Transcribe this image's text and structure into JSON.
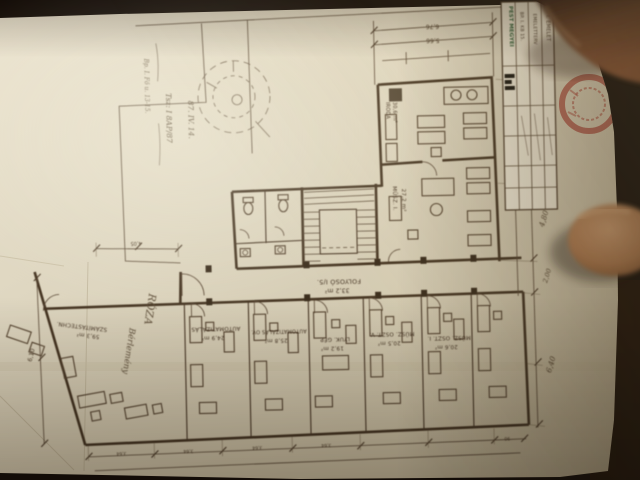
{
  "colors": {
    "table_surface": "#1a110a",
    "paper": "#ddd5bf",
    "ink": "#4a3826",
    "pencil": "#5f4f3a",
    "stamp_red": "#a63327",
    "skin": "#b5835f",
    "title_green": "#2f5c34"
  },
  "title_block": {
    "org": "PEST MEGYEI",
    "logo": "FTV",
    "row1": "BP. I. KB 15.",
    "row2": "EMELETTERV",
    "row3": "I. EMELET"
  },
  "handwritten_notes": {
    "line1": "Bp. I. Fő u. 13-15.",
    "line2": "Tsz: I 8AP/87",
    "line3": "87. IV. 14."
  },
  "site_notes": {
    "plot_name": "RÓZA",
    "plot_note": "Bérlemény"
  },
  "corridor": {
    "name": "FOLYOSÓ I/5.",
    "area": "33,2 m²"
  },
  "rooms": {
    "corner": {
      "name": "SZÁMÍTÁSTECHN.",
      "area": "59,3 m²"
    },
    "r1": {
      "name": "AUTOMATIZÁLÁS",
      "area": "24,9 m²"
    },
    "r2": {
      "name": "AUTOMATIZÁLÁS OV.",
      "area": "25,8 m²"
    },
    "r3": {
      "name": "LYUK. GÉP",
      "area": "19,2 m²"
    },
    "r4": {
      "name": "MŰSZ. OSZT. V.",
      "area": "20,5 m²"
    },
    "r5": {
      "name": "MŰSZ. OSZT. I.",
      "area": "20,6 m²"
    },
    "wing": {
      "name": "MŰSZ. I.",
      "area": "27,2 m²"
    },
    "wing_upper": {
      "name": "IRODA",
      "area": "30,6 m²"
    }
  },
  "dimensions": {
    "top1": "6,76",
    "top2": "5,66",
    "right1": "4,70",
    "right2": "4,80",
    "right3": "2,00",
    "right4": "6,40",
    "left1": "6,10",
    "inner1": "4,05",
    "bottom1": "3,64",
    "bottom2": "3,64",
    "bottom3": "3,64",
    "bottom4": "3,64",
    "bottom5": "90"
  }
}
